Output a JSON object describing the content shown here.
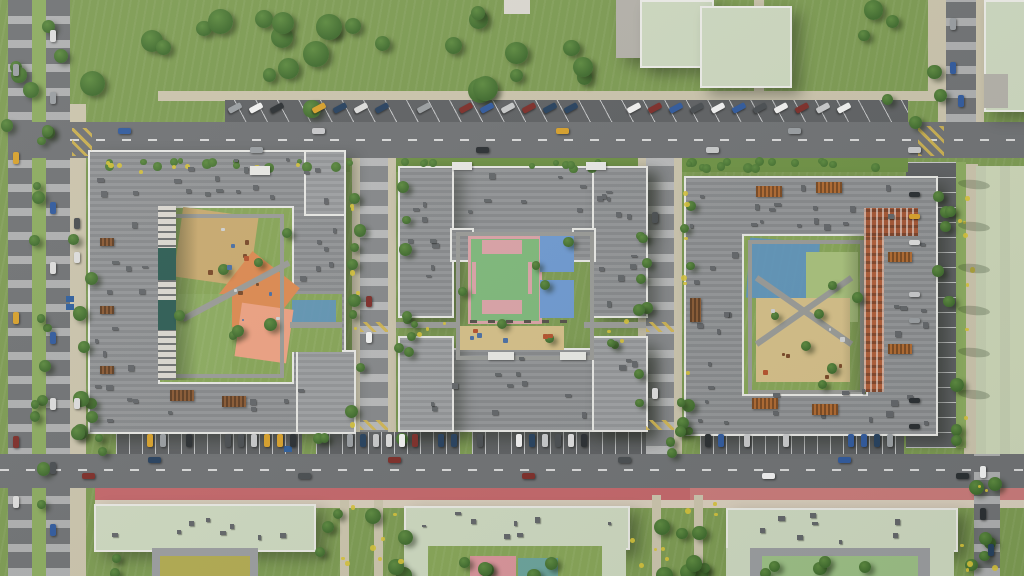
{
  "scene": {
    "name": "residential-complex-aerial-render",
    "view": "top-down bird's-eye 3D render",
    "description": "Aerial render of a residential quarter: three gray perimeter apartment blocks with courtyard playgrounds and sport courts, bounded by streets with parallel and perpendicular parking, a red cycle lane along the south avenue, kindergarten buildings with sage roofs to the south, park lawns with trees to the north and a pale green field to the east",
    "landmarks": [
      {
        "id": "block-west",
        "type": "apartment-block",
        "courtyard": [
          "sand playground",
          "orange playground",
          "salmon playground",
          "lawn",
          "blue pad"
        ]
      },
      {
        "id": "block-center",
        "type": "apartment-block",
        "courtyard": [
          "green sport court with pink markings",
          "blue court",
          "sand playground"
        ]
      },
      {
        "id": "block-east",
        "type": "apartment-block",
        "facade": "terracotta inner wing",
        "courtyard": [
          "blue playground",
          "green pad",
          "sand playground"
        ]
      },
      {
        "id": "south-buildings",
        "type": "kindergarten-school",
        "roof": "sage green"
      },
      {
        "id": "avenue-south",
        "features": [
          "perpendicular parking",
          "red bike lane"
        ]
      },
      {
        "id": "street-north",
        "features": [
          "angled parking"
        ]
      },
      {
        "id": "east-field",
        "type": "open field"
      }
    ]
  },
  "palette": {
    "grass": "#7d9b53",
    "grass_light": "#8cab60",
    "lawn": "#87a558",
    "hedge": "#6f9246",
    "tree_dark": "#3f6a2e",
    "tree_light": "#5d8a40",
    "asphalt": "#707275",
    "asphalt_dark": "#5f6164",
    "asphalt_light": "#86888b",
    "path": "#cbc4ad",
    "sidewalk_pink": "#d8cdbc",
    "roof": "#8e9093",
    "roof_light": "#9a9c9f",
    "parapet": "#e8e8e5",
    "sage_roof": "#cdd8c0",
    "white_wall": "#dbd8d1",
    "gray_wall": "#b4b1aa",
    "terracotta": "#b05e3a",
    "terracotta_dark": "#a55636",
    "bike_lane": "#c4676b",
    "bike_lane_faded": "#cf8c88",
    "sand": "#d5bf89",
    "sand_dark": "#c9aa70",
    "orange_play": "#dd8a52",
    "salmon_play": "#eda183",
    "court_green": "#7fb97c",
    "court_pink": "#dba3a8",
    "court_blue": "#6f9ad2",
    "play_blue": "#5d93c4",
    "olive_court": "#b2ab52",
    "pink_play": "#d9949b",
    "teal_play": "#6ba39c",
    "field": "#ccd6b8",
    "flower_yellow": "#d6c23a",
    "court_frame": "#9b9da0",
    "pergola_brown": "#8a5a35",
    "pergola_orange": "#b06a32",
    "facade_teal": "#2e5d55",
    "junction_yellow": "#d2b54e",
    "car_colors": [
      "#f2f2f2",
      "#dddddd",
      "#2b2f33",
      "#27415f",
      "#7e2e2a",
      "#d8a12c",
      "#4a4e52",
      "#9a9ea2",
      "#315a9e",
      "#c8c9cb"
    ]
  }
}
